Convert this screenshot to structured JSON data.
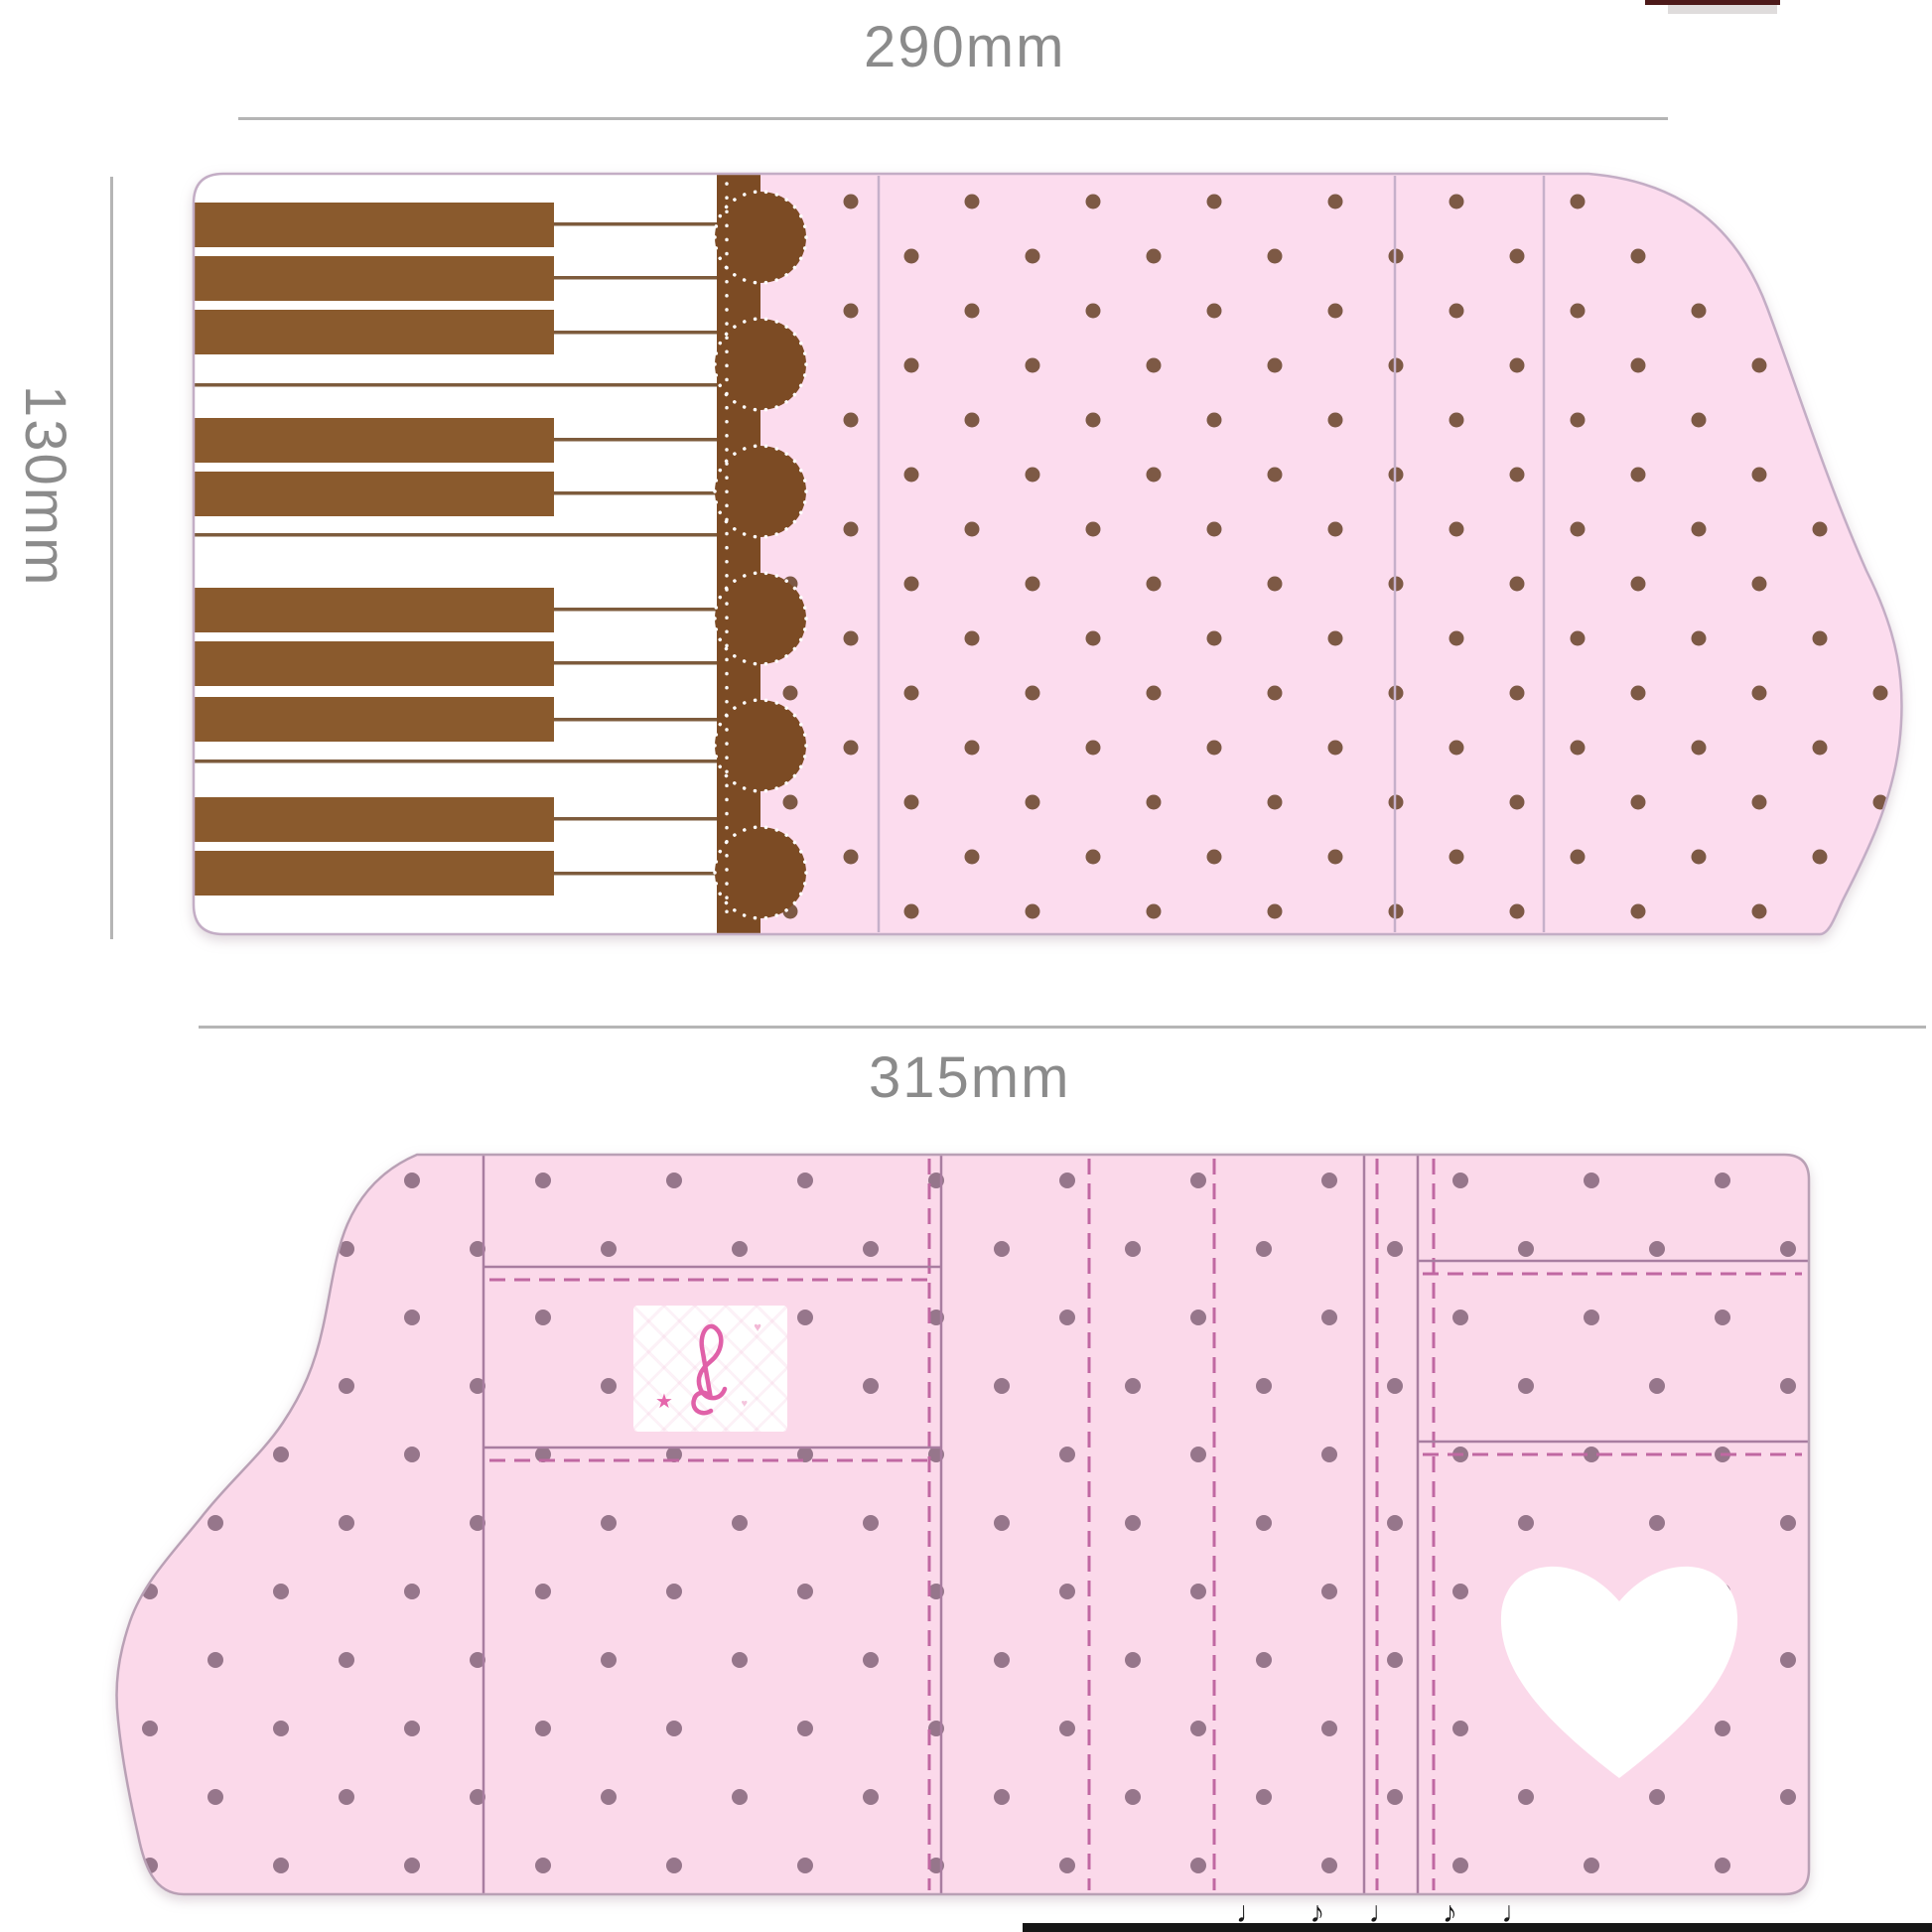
{
  "annotations": {
    "top_width_label": "290mm",
    "left_height_label": "130mm",
    "bottom_width_label": "315mm",
    "label_color": "#8b8b8b",
    "dimension_line_color": "#b5b5b5"
  },
  "closed_view": {
    "description": "piano themed wallet - closed outer cover with sideways keyboard, scalloped lace band and polka dots",
    "pink": "#fcdcee",
    "dot_color": "#6f4a33",
    "key_white": "#ffffff",
    "key_brown": "#8a5a2d",
    "scallop_brown": "#7c4b24",
    "fold_line_color": "#c6b0ca",
    "black_key_count": 10,
    "scallop_count": 6,
    "fold_line_count": 3
  },
  "open_view": {
    "description": "wallet opened inner view with stitched pockets, treble clef patch and white heart",
    "pink": "#fbd9ea",
    "dot_color": "#8d6e84",
    "seam_color": "#a87da0",
    "stitch_color": "#c068a2",
    "patch_icon": "treble-clef-icon",
    "heart_icon": "heart-icon",
    "heart_color": "#ffffff"
  },
  "artifacts": {
    "top_right_sliver_color": "#4d1a1a",
    "bottom_bar_color": "#161616",
    "bottom_glyphs": "♩ ♪ ♩ ♪ ♩"
  }
}
